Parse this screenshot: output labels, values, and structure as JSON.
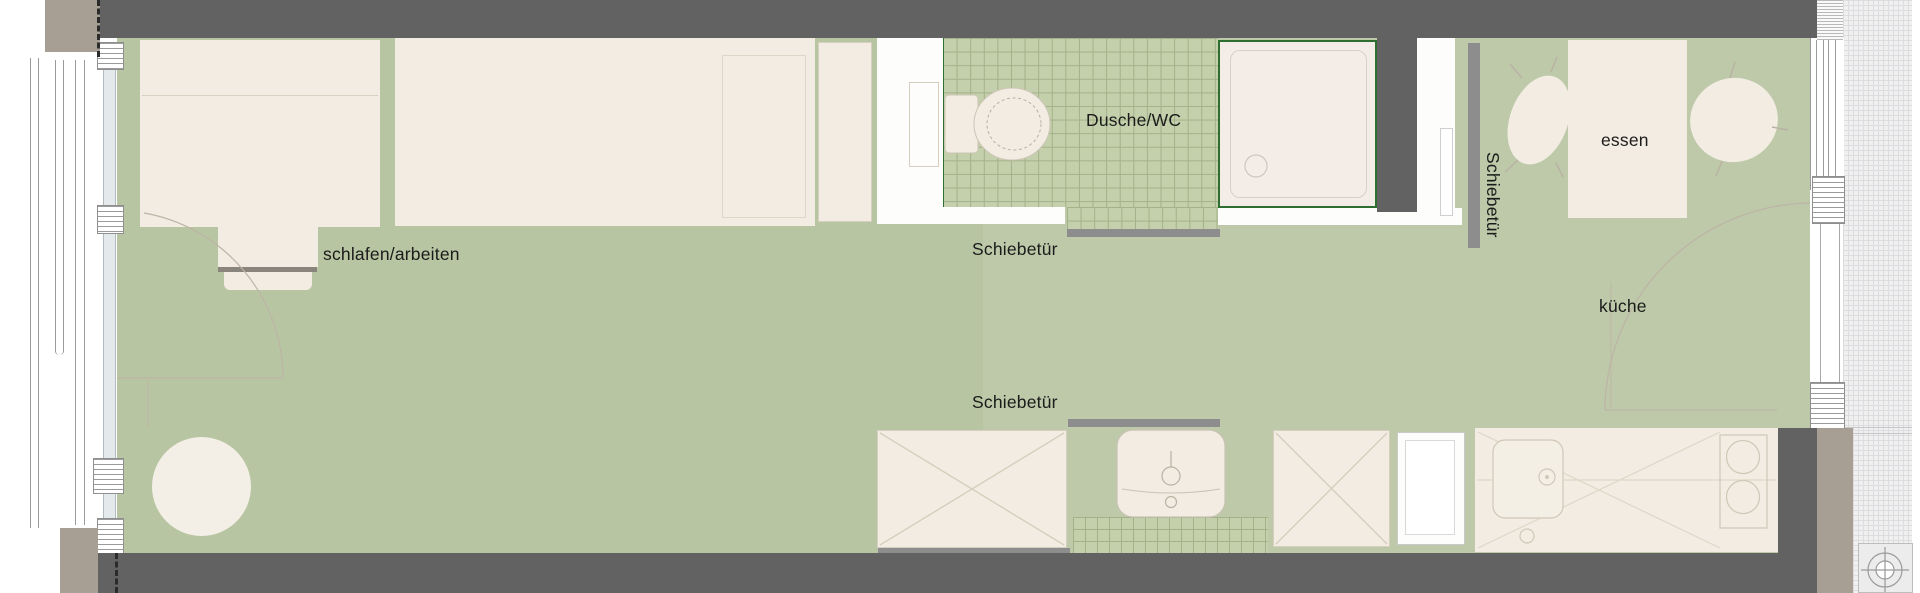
{
  "plan": {
    "type": "apartment-floor-plan",
    "labels": {
      "schlafen_arbeiten": "schlafen/arbeiten",
      "dusche_wc": "Dusche/WC",
      "essen": "essen",
      "kueche": "küche",
      "schiebetuer_top": "Schiebetür",
      "schiebetuer_bottom": "Schiebetür",
      "schiebetuer_vertical": "Schiebetür"
    },
    "rooms": [
      {
        "id": "schlafen-arbeiten",
        "label": "schlafen/arbeiten"
      },
      {
        "id": "dusche-wc",
        "label": "Dusche/WC"
      },
      {
        "id": "essen",
        "label": "essen"
      },
      {
        "id": "kueche",
        "label": "küche"
      }
    ],
    "fixtures": [
      "bed",
      "desk",
      "desk-chair",
      "round-table",
      "wardrobe-unit",
      "closet-panel",
      "toilet",
      "shower-tray",
      "washbasin",
      "wardrobe-x-1",
      "wardrobe-x-2",
      "fridge-cabinet",
      "kitchen-counter",
      "kitchen-sink",
      "cooktop",
      "dining-table",
      "chair-left",
      "chair-right",
      "sliding-doors",
      "survey-marker"
    ],
    "colors": {
      "floor": "#b8c5a2",
      "tile": "#c4cfab",
      "tile_grid": "#a3b189",
      "wall_dark": "#626262",
      "wall_taupe": "#a79f93",
      "furniture": "#f2ece2",
      "furniture_border": "#d6cfc0",
      "accent_green": "#2e6e2e",
      "slide_door": "#8d8d8d",
      "shower_fill": "#f4ece7",
      "glass": "#e4e9eb",
      "hatch_bg": "#f0f0f1",
      "hatch_line": "#dcdcde",
      "faint": "#bdb5a6",
      "text": "#1b1b1b"
    }
  }
}
